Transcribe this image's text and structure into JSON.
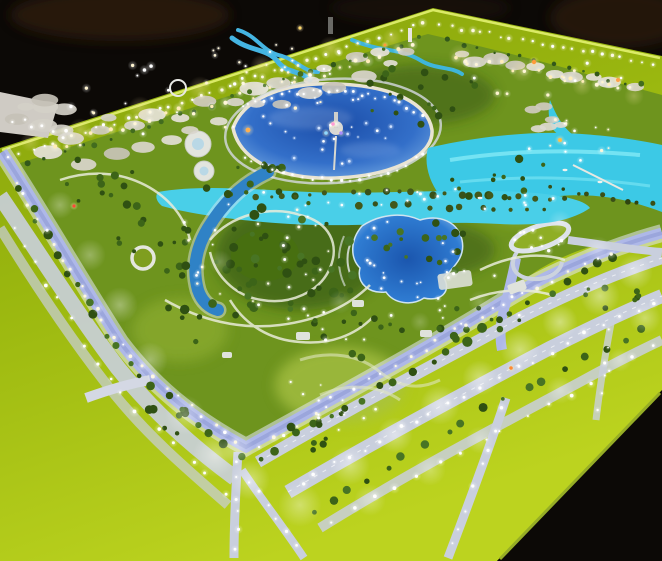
{
  "palette": {
    "backdrop": "#0c0906",
    "backdrop_brown": "#2e1c10",
    "slab": "#b6b1a8",
    "slab_edge": "#d8d4cc",
    "apron_dark": "#85a00c",
    "apron_mid": "#9ab70f",
    "apron_bright": "#bcd31f",
    "rim_glow": "#e2f170",
    "park_base": "#6e941e",
    "park_light": "#86a832",
    "lawn_dark": "#47700f",
    "shore": "#e9e4d2",
    "ring_road": "#d6dae2",
    "lagoon_deep": "#1b4da8",
    "lagoon_mid": "#336fc9",
    "lagoon_rim": "#7fb2e6",
    "turquoise": "#3cc9e6",
    "turquoise_band": "#49cfe8",
    "turquoise_light": "#8ceef8",
    "pool_deep": "#1b56ae",
    "pool_mid": "#2f7cd2",
    "river": "#2f82c6",
    "canal": "#aeb8e8",
    "canal_bank": "#e4e7f3",
    "canal_dark": "#8e9ad4",
    "road": "#c9cfdd",
    "road_dash": "#f2f4f8",
    "path": "#e9ecda",
    "building": "#d9d5cc",
    "fountain": "#d8d8d4",
    "table_side": "#96ad25",
    "light_white": "#ffffff",
    "light_warm": "#ffedb8"
  },
  "scatter": [
    {
      "l": "blobs",
      "t": "row",
      "p": [
        [
          40,
          152
        ],
        [
          418,
          44
        ]
      ],
      "n": 15,
      "r": 5,
      "j": 6,
      "c": [
        "#d9d5cc",
        "#cfcabf",
        "#e5e1d9"
      ]
    },
    {
      "l": "blobs",
      "t": "row",
      "p": [
        [
          72,
          166
        ],
        [
          402,
          60
        ]
      ],
      "n": 12,
      "r": 4.5,
      "j": 6,
      "c": [
        "#d9d5cc",
        "#c8c3b8",
        "#e2ded6"
      ]
    },
    {
      "l": "blobs",
      "t": "row",
      "p": [
        [
          448,
          54
        ],
        [
          640,
          90
        ]
      ],
      "n": 10,
      "r": 4.5,
      "j": 5,
      "c": [
        "#d9d5cc",
        "#cfcabf",
        "#e5e1d9"
      ]
    },
    {
      "l": "blobs",
      "t": "cluster",
      "e": [
        60,
        120,
        55,
        22
      ],
      "n": 8,
      "r": 5,
      "c": [
        "#d4d0c7",
        "#c6c1b6"
      ]
    },
    {
      "l": "blobs",
      "t": "cluster",
      "e": [
        565,
        118,
        55,
        13
      ],
      "n": 6,
      "r": 3.5,
      "c": [
        "#ddd9d0",
        "#cfcabf"
      ]
    },
    {
      "l": "trees",
      "t": "row",
      "p": [
        [
          15,
          185
        ],
        [
          130,
          365
        ],
        [
          245,
          462
        ]
      ],
      "n": 20,
      "r": 3.5,
      "j": 4,
      "c": [
        "#2f5012",
        "#3c6418",
        "#487424"
      ]
    },
    {
      "l": "trees",
      "t": "row",
      "p": [
        [
          252,
          462
        ],
        [
          440,
          355
        ],
        [
          625,
          252
        ]
      ],
      "n": 22,
      "r": 3.5,
      "j": 4,
      "c": [
        "#2f5012",
        "#3c6418",
        "#487424"
      ]
    },
    {
      "l": "trees",
      "t": "row",
      "p": [
        [
          300,
          520
        ],
        [
          480,
          412
        ],
        [
          655,
          322
        ]
      ],
      "n": 18,
      "r": 3,
      "j": 4,
      "c": [
        "#2f5012",
        "#3c6418",
        "#487424"
      ]
    },
    {
      "l": "trees",
      "t": "row",
      "p": [
        [
          22,
          168
        ],
        [
          424,
          36
        ]
      ],
      "n": 24,
      "r": 2,
      "j": 3,
      "c": [
        "#33581a",
        "#426c1e"
      ]
    },
    {
      "l": "trees",
      "t": "row",
      "p": [
        [
          440,
          40
        ],
        [
          648,
          88
        ]
      ],
      "n": 14,
      "r": 2,
      "j": 3,
      "c": [
        "#33581a",
        "#426c1e"
      ]
    },
    {
      "l": "trees",
      "t": "row",
      "p": [
        [
          545,
          186
        ],
        [
          658,
          206
        ]
      ],
      "n": 9,
      "r": 2.4,
      "j": 2,
      "c": [
        "#3a4f16",
        "#2f4410"
      ]
    },
    {
      "l": "trees",
      "t": "cluster",
      "e": [
        300,
        255,
        85,
        55
      ],
      "n": 36,
      "r": 3.4,
      "c": [
        "#2f5012",
        "#3c6418",
        "#487424"
      ]
    },
    {
      "l": "trees",
      "t": "cluster",
      "e": [
        205,
        300,
        55,
        45
      ],
      "n": 18,
      "r": 3.2,
      "c": [
        "#2f5012",
        "#3c6418"
      ]
    },
    {
      "l": "trees",
      "t": "cluster",
      "e": [
        255,
        185,
        65,
        22
      ],
      "n": 14,
      "r": 2.8,
      "c": [
        "#2f5012",
        "#3c6418"
      ]
    },
    {
      "l": "trees",
      "t": "cluster",
      "e": [
        430,
        250,
        65,
        28
      ],
      "n": 16,
      "r": 3,
      "c": [
        "#2f5012",
        "#3c6418",
        "#487424"
      ]
    },
    {
      "l": "trees",
      "t": "cluster",
      "e": [
        505,
        180,
        55,
        22
      ],
      "n": 12,
      "r": 2.8,
      "c": [
        "#2f5012",
        "#3c6418"
      ]
    },
    {
      "l": "trees",
      "t": "cluster",
      "e": [
        420,
        95,
        75,
        30
      ],
      "n": 18,
      "r": 2.6,
      "c": [
        "#2f5012",
        "#3c6418"
      ]
    },
    {
      "l": "trees",
      "t": "cluster",
      "e": [
        150,
        225,
        42,
        32
      ],
      "n": 12,
      "r": 3,
      "c": [
        "#2f5012",
        "#3c6418"
      ]
    },
    {
      "l": "trees",
      "t": "cluster",
      "e": [
        90,
        180,
        45,
        25
      ],
      "n": 10,
      "r": 2.8,
      "c": [
        "#2f5012",
        "#3c6418"
      ]
    },
    {
      "l": "trees",
      "t": "cluster",
      "e": [
        480,
        330,
        50,
        25
      ],
      "n": 10,
      "r": 2.8,
      "c": [
        "#2f5012",
        "#3c6418"
      ]
    },
    {
      "l": "trees",
      "t": "cluster",
      "e": [
        350,
        335,
        55,
        28
      ],
      "n": 12,
      "r": 2.8,
      "c": [
        "#2f5012",
        "#3c6418"
      ]
    },
    {
      "l": "trees",
      "t": "cluster",
      "e": [
        605,
        300,
        40,
        16
      ],
      "n": 8,
      "r": 2.6,
      "c": [
        "#2f5012",
        "#3c6418"
      ]
    },
    {
      "l": "trees",
      "t": "cluster",
      "e": [
        160,
        420,
        30,
        20
      ],
      "n": 8,
      "r": 3,
      "c": [
        "#2f5012",
        "#3c6418"
      ]
    },
    {
      "l": "trees",
      "t": "cluster",
      "e": [
        330,
        430,
        40,
        22
      ],
      "n": 8,
      "r": 3,
      "c": [
        "#2f5012",
        "#3c6418"
      ]
    },
    {
      "l": "cabanas",
      "t": "row",
      "p": [
        [
          345,
          191
        ],
        [
          575,
          199
        ]
      ],
      "n": 15,
      "r": 3,
      "j": 2,
      "c": [
        "#42581a",
        "#38511a"
      ]
    },
    {
      "l": "cabanas",
      "t": "row",
      "p": [
        [
          352,
          204
        ],
        [
          556,
          211
        ]
      ],
      "n": 12,
      "r": 2.6,
      "j": 2,
      "c": [
        "#42581a",
        "#38511a"
      ]
    },
    {
      "l": "cabanas",
      "t": "row",
      "p": [
        [
          250,
          196
        ],
        [
          330,
          194
        ]
      ],
      "n": 6,
      "r": 2.4,
      "j": 2,
      "c": [
        "#42581a"
      ]
    },
    {
      "l": "lights",
      "t": "row",
      "p": [
        [
          5,
          158
        ],
        [
          428,
          22
        ]
      ],
      "n": 40,
      "r": 1.2,
      "j": 2,
      "c": [
        "#ffffff",
        "#fdf8e2"
      ]
    },
    {
      "l": "lights",
      "t": "row",
      "p": [
        [
          436,
          24
        ],
        [
          656,
          64
        ]
      ],
      "n": 22,
      "r": 1.2,
      "j": 2,
      "c": [
        "#ffffff",
        "#fdf8e2"
      ]
    },
    {
      "l": "lights",
      "t": "row",
      "p": [
        [
          45,
          150
        ],
        [
          418,
          48
        ]
      ],
      "n": 26,
      "r": 1.4,
      "j": 5,
      "c": [
        "#ffedb8",
        "#fff6d8"
      ]
    },
    {
      "l": "lights",
      "t": "row",
      "p": [
        [
          448,
          55
        ],
        [
          638,
          92
        ]
      ],
      "n": 16,
      "r": 1.4,
      "j": 4,
      "c": [
        "#ffedb8",
        "#fff6d8"
      ]
    },
    {
      "l": "lights",
      "t": "row",
      "p": [
        [
          238,
          108
        ],
        [
          280,
          94
        ],
        [
          335,
          90
        ],
        [
          390,
          99
        ],
        [
          426,
          116
        ]
      ],
      "n": 24,
      "r": 1.1,
      "j": 2,
      "c": [
        "#ffffff"
      ]
    },
    {
      "l": "lights",
      "t": "row",
      "p": [
        [
          240,
          155
        ],
        [
          290,
          176
        ],
        [
          340,
          181
        ],
        [
          395,
          173
        ],
        [
          428,
          152
        ]
      ],
      "n": 20,
      "r": 1.1,
      "j": 2,
      "c": [
        "#ffffff"
      ]
    },
    {
      "l": "lights",
      "t": "row",
      "p": [
        [
          10,
          175
        ],
        [
          120,
          345
        ],
        [
          243,
          450
        ]
      ],
      "n": 24,
      "r": 1.3,
      "j": 3,
      "c": [
        "#ffffff",
        "#fdf8e2"
      ]
    },
    {
      "l": "lights",
      "t": "row",
      "p": [
        [
          4,
          215
        ],
        [
          115,
          390
        ],
        [
          230,
          500
        ]
      ],
      "n": 16,
      "r": 1.3,
      "j": 3,
      "c": [
        "#ffffff"
      ]
    },
    {
      "l": "lights",
      "t": "row",
      "p": [
        [
          250,
          452
        ],
        [
          420,
          352
        ],
        [
          505,
          302
        ],
        [
          620,
          248
        ]
      ],
      "n": 26,
      "r": 1.3,
      "j": 3,
      "c": [
        "#ffffff",
        "#fdf8e2"
      ]
    },
    {
      "l": "lights",
      "t": "row",
      "p": [
        [
          290,
          488
        ],
        [
          470,
          392
        ],
        [
          660,
          298
        ]
      ],
      "n": 22,
      "r": 1.3,
      "j": 3,
      "c": [
        "#ffffff"
      ]
    },
    {
      "l": "lights",
      "t": "row",
      "p": [
        [
          322,
          524
        ],
        [
          520,
          422
        ],
        [
          660,
          342
        ]
      ],
      "n": 16,
      "r": 1.3,
      "j": 3,
      "c": [
        "#ffffff"
      ]
    },
    {
      "l": "lights",
      "t": "row",
      "p": [
        [
          505,
          400
        ],
        [
          450,
          556
        ]
      ],
      "n": 8,
      "r": 1.2,
      "j": 2,
      "c": [
        "#ffffff"
      ]
    },
    {
      "l": "lights",
      "t": "row",
      "p": [
        [
          238,
          455
        ],
        [
          236,
          556
        ]
      ],
      "n": 6,
      "r": 1.2,
      "j": 2,
      "c": [
        "#ffffff"
      ]
    },
    {
      "l": "lights",
      "t": "row",
      "p": [
        [
          244,
          472
        ],
        [
          302,
          556
        ]
      ],
      "n": 6,
      "r": 1.2,
      "j": 2,
      "c": [
        "#ffffff"
      ]
    },
    {
      "l": "lights",
      "t": "row",
      "p": [
        [
          612,
          320
        ],
        [
          596,
          418
        ]
      ],
      "n": 6,
      "r": 1.1,
      "j": 2,
      "c": [
        "#ffffff"
      ]
    },
    {
      "l": "lights",
      "t": "row",
      "p": [
        [
          8,
          118
        ],
        [
          68,
          134
        ]
      ],
      "n": 6,
      "r": 1.3,
      "j": 3,
      "c": [
        "#ffffff"
      ]
    },
    {
      "l": "lights",
      "t": "cluster",
      "e": [
        280,
        62,
        85,
        26
      ],
      "n": 22,
      "r": 1.1,
      "c": [
        "#ffffff",
        "#fff6d8"
      ]
    },
    {
      "l": "lights",
      "t": "cluster",
      "e": [
        260,
        250,
        90,
        60
      ],
      "n": 26,
      "r": 1.1,
      "c": [
        "#ffffff",
        "#fdf8e2"
      ]
    },
    {
      "l": "lights",
      "t": "cluster",
      "e": [
        350,
        305,
        70,
        45
      ],
      "n": 16,
      "r": 1.1,
      "c": [
        "#ffffff"
      ]
    },
    {
      "l": "lights",
      "t": "cluster",
      "e": [
        470,
        300,
        60,
        35
      ],
      "n": 12,
      "r": 1.1,
      "c": [
        "#ffffff"
      ]
    },
    {
      "l": "lights",
      "t": "cluster",
      "e": [
        560,
        140,
        55,
        28
      ],
      "n": 14,
      "r": 1.1,
      "c": [
        "#ffffff",
        "#fff6d8"
      ]
    },
    {
      "l": "lights",
      "t": "cluster",
      "e": [
        440,
        200,
        115,
        13
      ],
      "n": 16,
      "r": 1,
      "c": [
        "#ffffff"
      ]
    },
    {
      "l": "lights",
      "t": "cluster",
      "e": [
        405,
        260,
        58,
        42
      ],
      "n": 12,
      "r": 1,
      "c": [
        "#ffffff"
      ]
    },
    {
      "l": "lights",
      "t": "cluster",
      "e": [
        540,
        240,
        30,
        12
      ],
      "n": 10,
      "r": 1.2,
      "c": [
        "#ffffff"
      ]
    },
    {
      "l": "lights",
      "t": "cluster",
      "e": [
        340,
        390,
        70,
        40
      ],
      "n": 12,
      "r": 1,
      "c": [
        "#ffffff"
      ]
    },
    {
      "l": "lights",
      "t": "cluster",
      "e": [
        330,
        130,
        80,
        35
      ],
      "n": 22,
      "r": 1,
      "c": [
        "#ffffff",
        "#cfe2ff"
      ]
    },
    {
      "l": "lights",
      "t": "cluster",
      "e": [
        200,
        100,
        140,
        40
      ],
      "n": 20,
      "r": 1.2,
      "c": [
        "#fff4d0",
        "#ffffff"
      ]
    },
    {
      "l": "lights",
      "t": "cluster",
      "e": [
        545,
        75,
        90,
        25
      ],
      "n": 12,
      "r": 1.2,
      "c": [
        "#fff4d0",
        "#ffffff"
      ]
    }
  ],
  "glow_patches": [
    [
      60,
      205,
      14,
      0.3,
      "w"
    ],
    [
      90,
      255,
      16,
      0.3,
      "w"
    ],
    [
      120,
      305,
      18,
      0.35,
      "w"
    ],
    [
      150,
      360,
      18,
      0.35,
      "w"
    ],
    [
      185,
      415,
      20,
      0.35,
      "w"
    ],
    [
      215,
      455,
      22,
      0.4,
      "w"
    ],
    [
      250,
      480,
      20,
      0.4,
      "w"
    ],
    [
      300,
      505,
      22,
      0.35,
      "w"
    ],
    [
      350,
      465,
      20,
      0.4,
      "w"
    ],
    [
      395,
      435,
      18,
      0.4,
      "w"
    ],
    [
      440,
      405,
      20,
      0.42,
      "w"
    ],
    [
      480,
      378,
      18,
      0.4,
      "w"
    ],
    [
      520,
      350,
      20,
      0.4,
      "w"
    ],
    [
      560,
      322,
      18,
      0.42,
      "w"
    ],
    [
      600,
      296,
      20,
      0.42,
      "w"
    ],
    [
      635,
      272,
      18,
      0.4,
      "w"
    ],
    [
      645,
      318,
      16,
      0.35,
      "w"
    ],
    [
      430,
      470,
      16,
      0.3,
      "w"
    ],
    [
      370,
      500,
      16,
      0.3,
      "w"
    ],
    [
      480,
      440,
      14,
      0.3,
      "w"
    ],
    [
      560,
      390,
      14,
      0.3,
      "w"
    ],
    [
      620,
      360,
      12,
      0.3,
      "w"
    ],
    [
      238,
      448,
      16,
      0.38,
      "w"
    ],
    [
      598,
      250,
      14,
      0.3,
      "w"
    ],
    [
      80,
      130,
      12,
      0.3,
      "a"
    ],
    [
      140,
      108,
      12,
      0.3,
      "a"
    ],
    [
      200,
      88,
      12,
      0.3,
      "a"
    ],
    [
      262,
      66,
      12,
      0.32,
      "a"
    ],
    [
      330,
      48,
      12,
      0.32,
      "a"
    ],
    [
      392,
      38,
      10,
      0.3,
      "a"
    ],
    [
      460,
      56,
      12,
      0.3,
      "a"
    ],
    [
      522,
      70,
      12,
      0.3,
      "a"
    ],
    [
      582,
      86,
      10,
      0.3,
      "a"
    ],
    [
      30,
      142,
      10,
      0.28,
      "a"
    ],
    [
      634,
      96,
      10,
      0.28,
      "a"
    ],
    [
      265,
      90,
      14,
      0.25,
      "w"
    ],
    [
      220,
      262,
      12,
      0.22,
      "w"
    ],
    [
      480,
      302,
      12,
      0.22,
      "w"
    ],
    [
      560,
      222,
      12,
      0.25,
      "w"
    ],
    [
      340,
      302,
      12,
      0.22,
      "w"
    ],
    [
      420,
      322,
      10,
      0.2,
      "w"
    ]
  ],
  "accent_lights": [
    [
      534,
      62,
      "#ff9a3a",
      2.2
    ],
    [
      618,
      80,
      "#ffa04a",
      2.0
    ],
    [
      248,
      130,
      "#ffb050",
      2.4
    ],
    [
      511,
      368,
      "#ff8a30",
      1.8
    ],
    [
      560,
      140,
      "#ffc04a",
      2.0
    ],
    [
      74,
      206,
      "#ff4838",
      1.6
    ],
    [
      333,
      124,
      "#ff9ad6",
      1.8
    ],
    [
      341,
      133,
      "#a88cff",
      1.8
    ],
    [
      326,
      133,
      "#8fd8ff",
      1.8
    ],
    [
      300,
      28,
      "#ffd86a",
      1.6
    ],
    [
      385,
      45,
      "#ff9a3a",
      1.5
    ]
  ],
  "boats": [
    [
      565,
      170
    ],
    [
      600,
      182
    ],
    [
      480,
      198
    ]
  ]
}
